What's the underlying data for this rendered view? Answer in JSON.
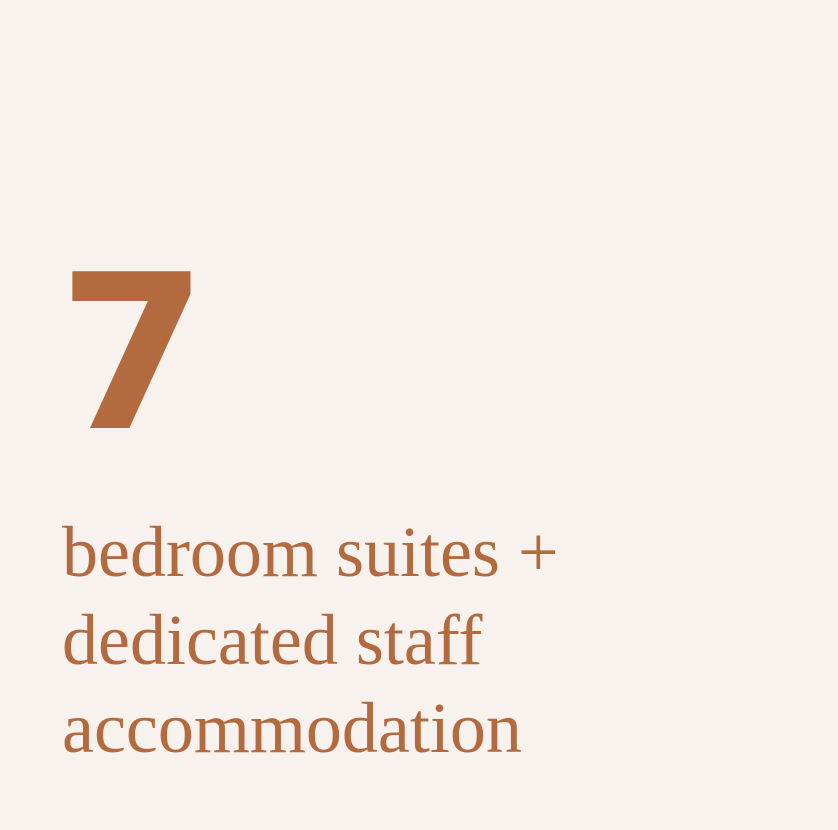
{
  "theme": {
    "background": "#F7F2ED",
    "accent": "#B26A3E"
  },
  "stat": {
    "value": "7",
    "lines": [
      "bedroom suites +",
      "dedicated staff",
      "accommodation"
    ],
    "description": "bedroom suites + dedicated staff accommodation"
  }
}
